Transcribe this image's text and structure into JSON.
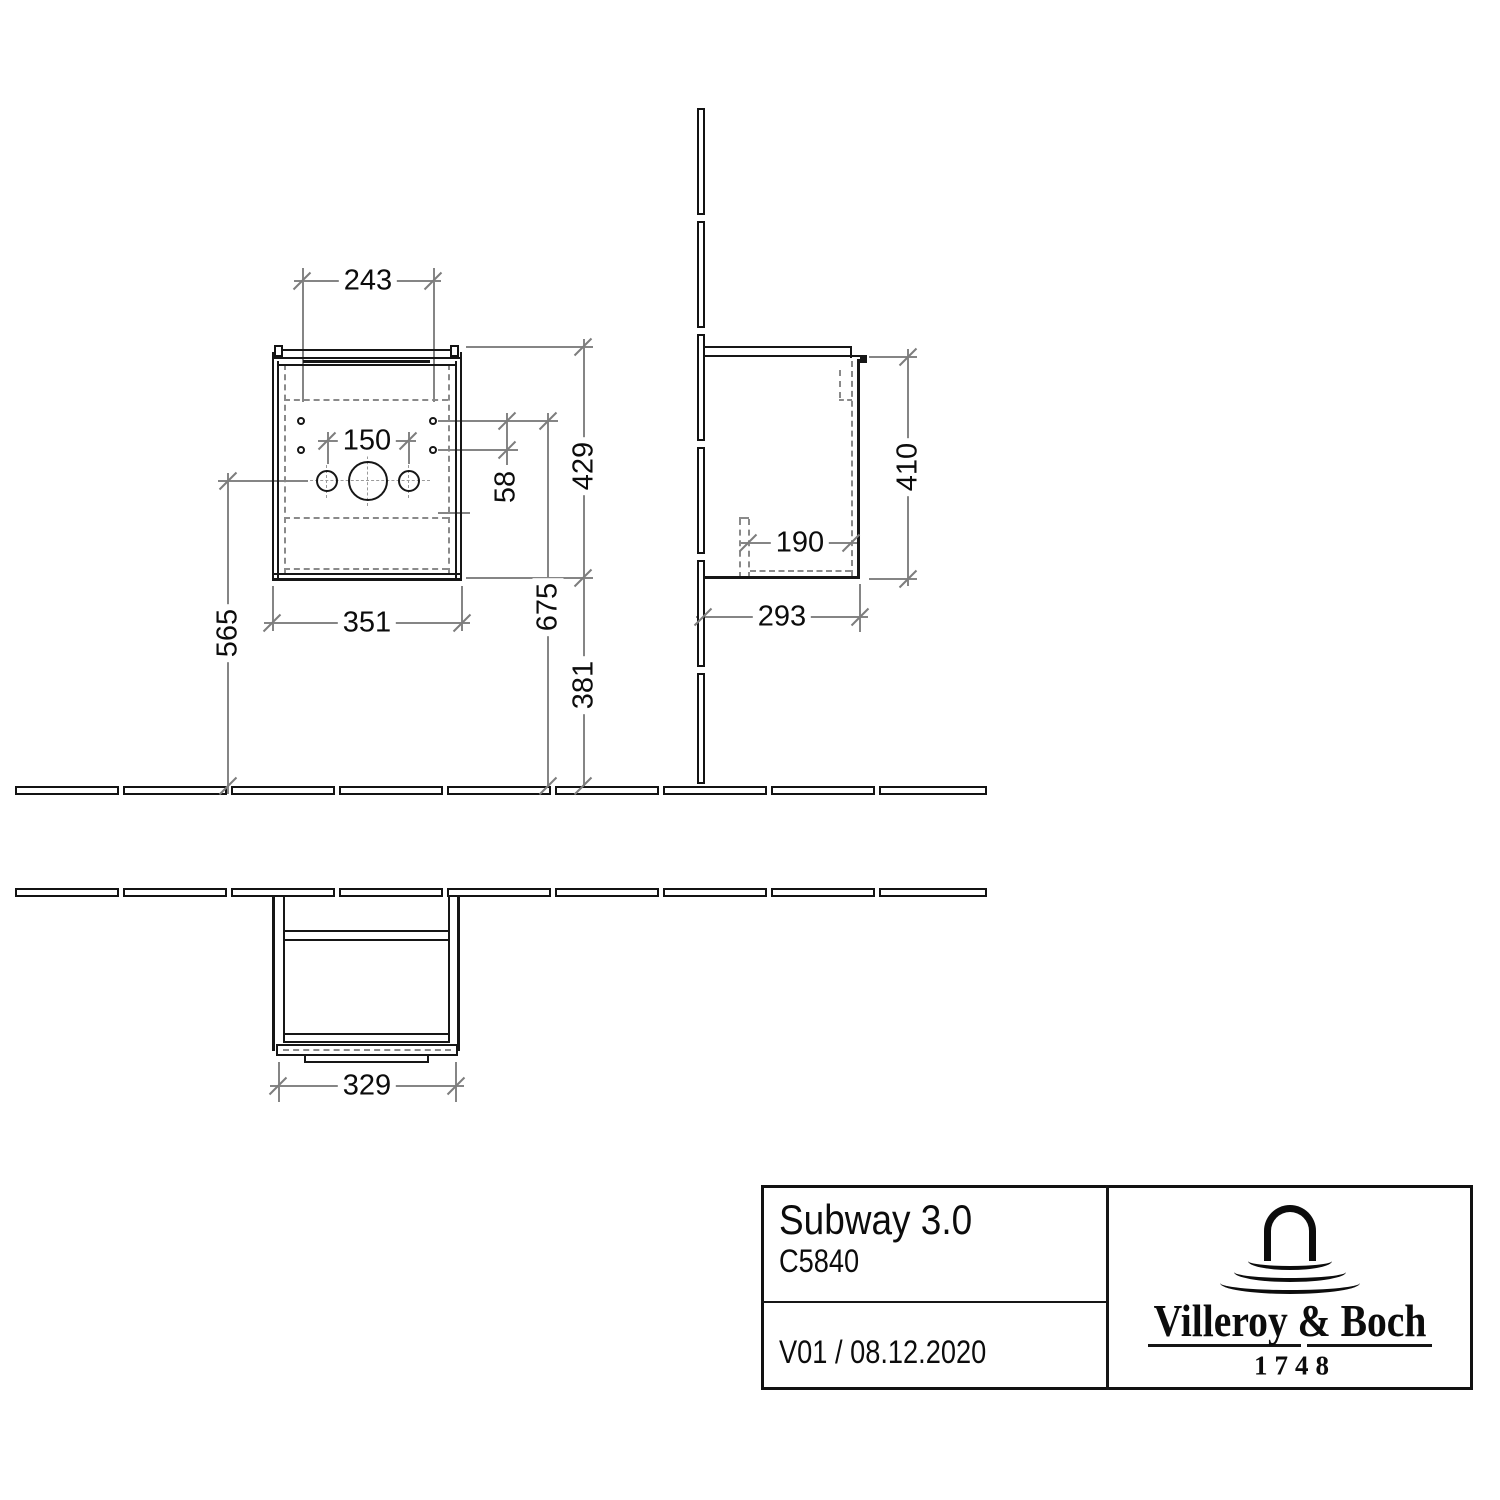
{
  "dims": {
    "front": {
      "hole_span_h": "243",
      "tap_span": "150",
      "hole_span_v": "58",
      "height_overall": "429",
      "siphon_height": "565",
      "width": "351",
      "upper_holes_height": "675",
      "bottom_height": "381"
    },
    "side": {
      "height": "410",
      "siphon_offset": "190",
      "depth": "293"
    },
    "top": {
      "front_width": "329"
    }
  },
  "title_block": {
    "series": "Subway 3.0",
    "article": "C5840",
    "version": "V01 / 08.12.2020",
    "brand": "Villeroy & Boch",
    "established": "1748"
  }
}
